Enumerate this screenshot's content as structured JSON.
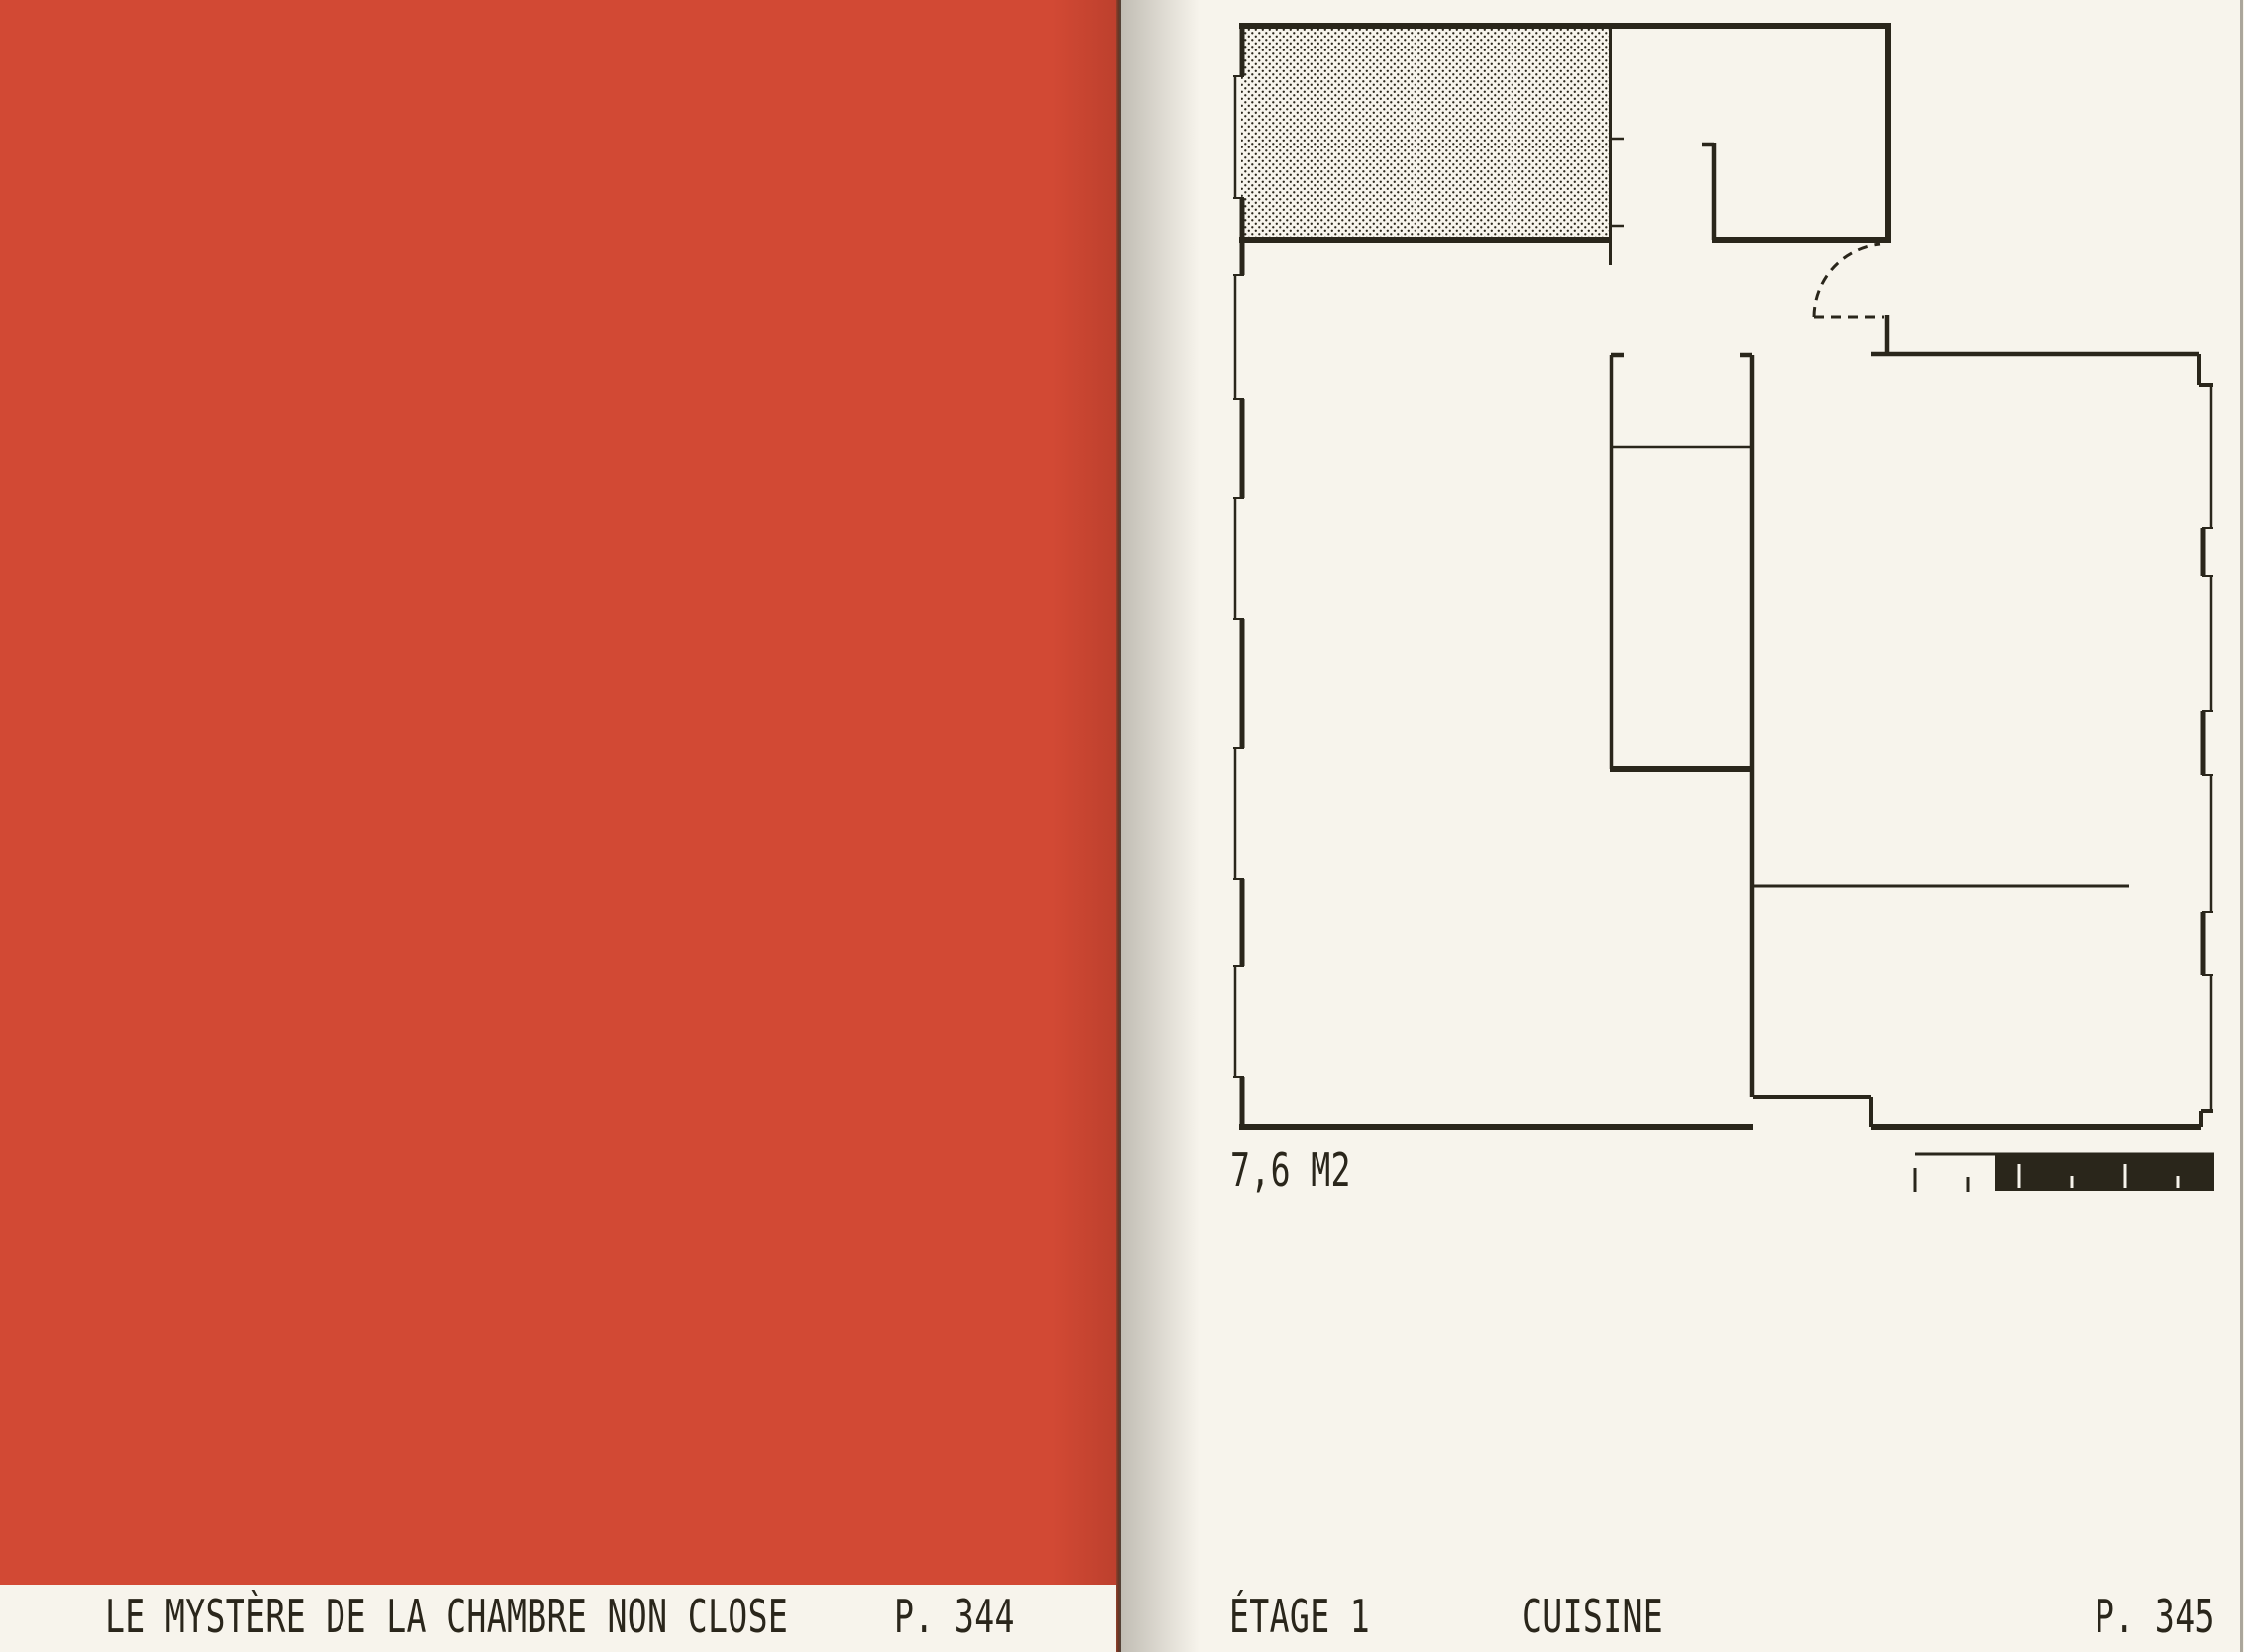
{
  "book": {
    "left_page": {
      "caption_title": "LE MYSTÈRE DE LA CHAMBRE NON CLOSE",
      "page_number": "P. 344"
    },
    "right_page": {
      "floor_caption": "ÉTAGE 1",
      "room_caption": "CUISINE",
      "page_number": "P. 345",
      "plan": {
        "area_label": "7,6 M2",
        "kind": "architectural floor plan",
        "hatched_region": "dotted hatch room, top-left",
        "door": "dashed quarter-circle swing arc",
        "scale_bar": "graphic scale, half solid block with ticks"
      }
    }
  },
  "colors": {
    "red": "#d24934",
    "paper": "#f7f4ec",
    "ink": "#2a261b"
  }
}
